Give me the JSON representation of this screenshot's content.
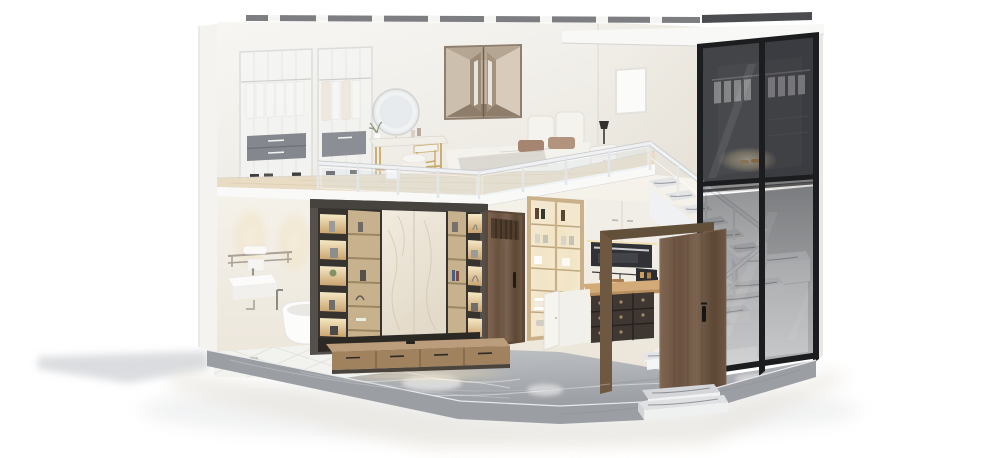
{
  "meta": {
    "title": "3D cutaway render of a two-storey loft apartment on a marble base",
    "type": "3d-interior-render",
    "background": "#ffffff"
  },
  "palette": {
    "bg": "#ffffff",
    "cut_edge": "#f4f3f0",
    "wall_upper": "#f4f2ee",
    "wall_right": "#efece6",
    "wall_lower": "#f3efe7",
    "top_cut": "#6f7073",
    "cornice": "#f8f8f6",
    "slab": "#f9f9f8",
    "wood_floor": "#e9dcc4",
    "railing_white": "#eff1f3",
    "railing_glass": "#dbe4ec",
    "wardrobe_frame": "#dcdcda",
    "drawer_gray": "#84878d",
    "gold": "#c8a868",
    "art_taupe": "#c2b2a0",
    "bed_white": "#f4f2ed",
    "pillow_brown": "#a68570",
    "poster_white": "#fbfbfa",
    "tv_frame_bronze": "#55504b",
    "shelf_wood": "#c8b28e",
    "marble_panel": "#efe8dd",
    "cubby_glow": "#f3e2ba",
    "console_wood": "#bb9d7c",
    "walnut_door": "#7a6150",
    "frame_black": "#1c1d1f",
    "glass_smoke": "#53545a",
    "cabinet_gold": "#c9b088",
    "cabinet_white": "#f1eee8",
    "oven_dark": "#303236",
    "counter_wood": "#d2ab79",
    "wine_rack": "#3f3832",
    "tread_marble": "#e2e4e6",
    "stair_white": "#f0f1f3",
    "marble_floor": "#a9acb0",
    "platform_side": "#9b9ea3",
    "tile_white": "#f2f2ef",
    "chrome": "#a8a195",
    "glow_warm": "#f7e9c8",
    "ground_shadow": "#b6bac0",
    "ground_reflection": "#e5e0d6"
  },
  "scene": {
    "upper_level": {
      "objects": [
        "glass-wardrobe-cabinets",
        "hanging-white-clothes",
        "gray-drawer-boxes",
        "vanity-table",
        "led-round-mirror",
        "gold-vanity-stool",
        "white-pouf",
        "geometric-mirror-wall-art",
        "platform-bed",
        "brown-pillows",
        "white-nightstand",
        "black-table-lamp",
        "white-framed-poster",
        "light-wood-floor",
        "white-glass-railing"
      ]
    },
    "lower_level": {
      "objects": [
        "towel-rack-with-towel",
        "wall-hung-sink",
        "freestanding-bathtub",
        "floor-standing-faucet",
        "white-tile-floor",
        "marble-tv-feature-wall",
        "backlit-display-shelves",
        "floating-wood-tv-console",
        "closed-walnut-door",
        "gold-framed-glass-display-cabinet",
        "white-upper-cabinets",
        "built-in-oven",
        "wood-countertop",
        "dark-wine-rack",
        "white-base-cabinet",
        "gray-marble-floor"
      ]
    },
    "right_wing": {
      "objects": [
        "smoked-glass-curtain-wall",
        "black-frame-mullions",
        "walk-in-closet-behind-glass",
        "white-roof-cornice",
        "staircase-with-marble-treads",
        "white-stair-railing",
        "open-walnut-entry-door",
        "two-tier-entry-step"
      ]
    },
    "base": {
      "objects": [
        "gray-marble-platform-slab",
        "cast-shadow-left",
        "soft-floor-reflection"
      ]
    }
  }
}
